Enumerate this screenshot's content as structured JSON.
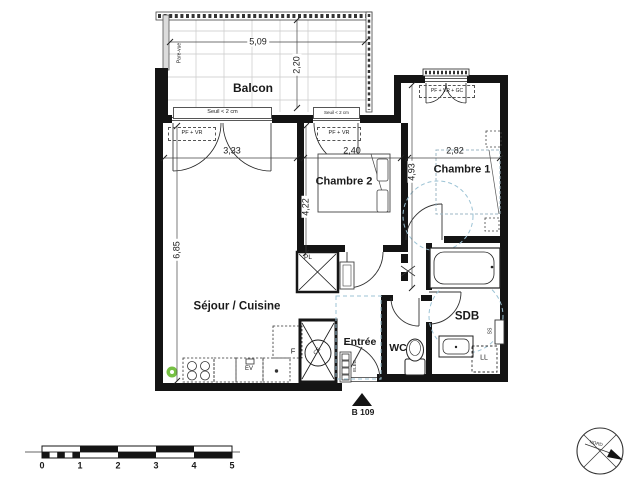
{
  "plan": {
    "rooms": {
      "balcony": "Balcon",
      "living": "Séjour / Cuisine",
      "bedroom1": "Chambre 1",
      "bedroom2": "Chambre 2",
      "entry": "Entrée",
      "wc": "WC",
      "bathroom": "SDB"
    },
    "dimensions": {
      "balcony_width": "5,09",
      "balcony_depth": "2,20",
      "living_width": "3,33",
      "bedroom2_width": "2,40",
      "bedroom1_width": "2,82",
      "bedroom2_depth": "4,22",
      "bedroom1_depth": "4,93",
      "living_depth": "6,85"
    },
    "annotations": {
      "window_living": "PF + VR",
      "window_bedroom2": "PF + VR",
      "window_bedroom1": "PF + VR + GC",
      "threshold_left": "Seuil < 2 cm",
      "threshold_right": "Seuil < 2 cm",
      "privacy_screen": "Pare-vue",
      "closet": "PL",
      "water_heater": "CE",
      "fridge": "F",
      "kitchen_sink": "EV",
      "washing_machine": "LL",
      "towel_rail": "SS",
      "electrical_panel": "ELEC",
      "unit_number": "B 109"
    }
  },
  "scale_bar": {
    "ticks": [
      "0",
      "1",
      "2",
      "3",
      "4",
      "5"
    ]
  },
  "compass": {
    "label": "NORD"
  },
  "colors": {
    "wall": "#141414",
    "accessibility_blue": "#9cc3d5",
    "marker_green": "#76c043",
    "tile_gray": "#c9c9c9"
  }
}
